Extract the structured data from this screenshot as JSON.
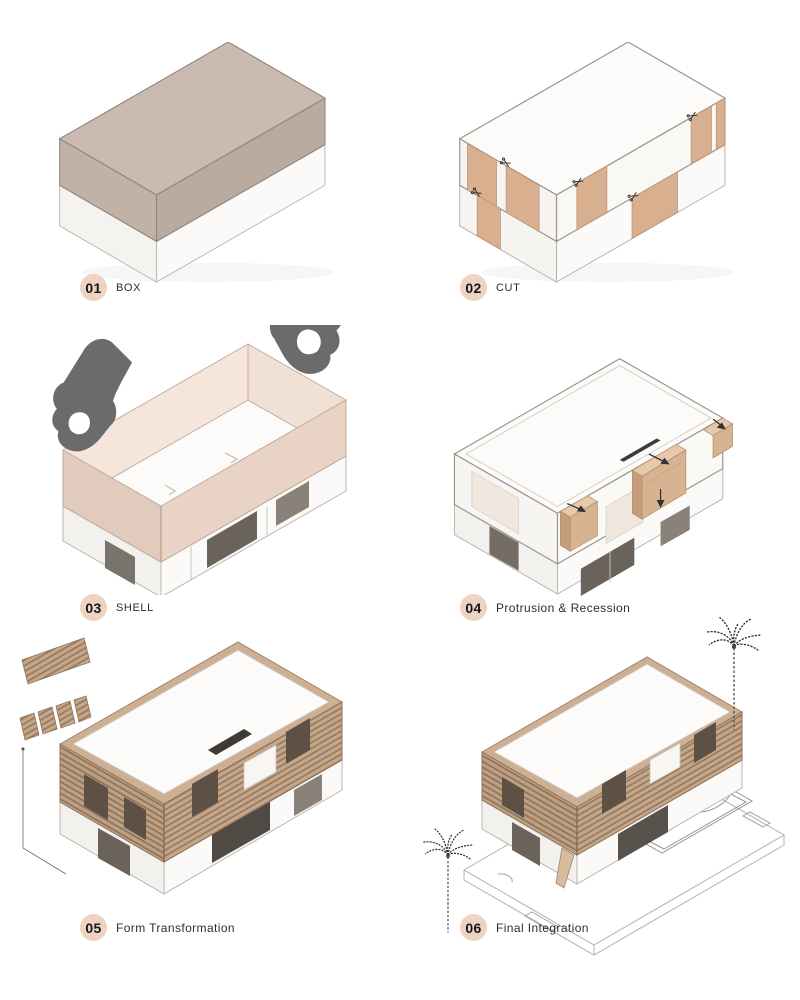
{
  "title": "Architectural Form Development Diagram",
  "steps": [
    {
      "number": "01",
      "label": "BOX",
      "illustration": "solid-box"
    },
    {
      "number": "02",
      "label": "CUT",
      "illustration": "cut-box-with-scissors"
    },
    {
      "number": "03",
      "label": "SHELL",
      "illustration": "shell-lifted-by-hands"
    },
    {
      "number": "04",
      "label": "Protrusion & Recession",
      "illustration": "protrusion-recession-massing"
    },
    {
      "number": "05",
      "label": "Form Transformation",
      "illustration": "wood-slat-facade-building"
    },
    {
      "number": "06",
      "label": "Final Integration",
      "illustration": "building-with-site-pool-palms"
    }
  ],
  "icons": [
    "scissors-icon",
    "hand-icon",
    "arrow-icon",
    "palm-tree-icon"
  ],
  "badge": {
    "background": "#EED3C3",
    "number_color": "#15151E"
  },
  "palette": {
    "background": "#FFFFFF",
    "taupe_top": "#CBBAB0",
    "taupe_left": "#C2B1A7",
    "taupe_right": "#BAABA1",
    "white_face": "#FBFAF8",
    "edge_gray": "#9B948C",
    "cut_panel_tan": "#D8AF8F",
    "shell_outer_pink": "#E9D3C5",
    "shell_inner_pink": "#F5E5DA",
    "shell_end_pink": "#E1CBBC",
    "hand_gray": "#6B6B6B",
    "protrusion_tan": "#D8B392",
    "wood_tan": "#C4A68A",
    "wood_line": "#96795E",
    "window_void": "#5D5045",
    "label_text": "#2D2D2D",
    "line_art": "#8D8780"
  }
}
